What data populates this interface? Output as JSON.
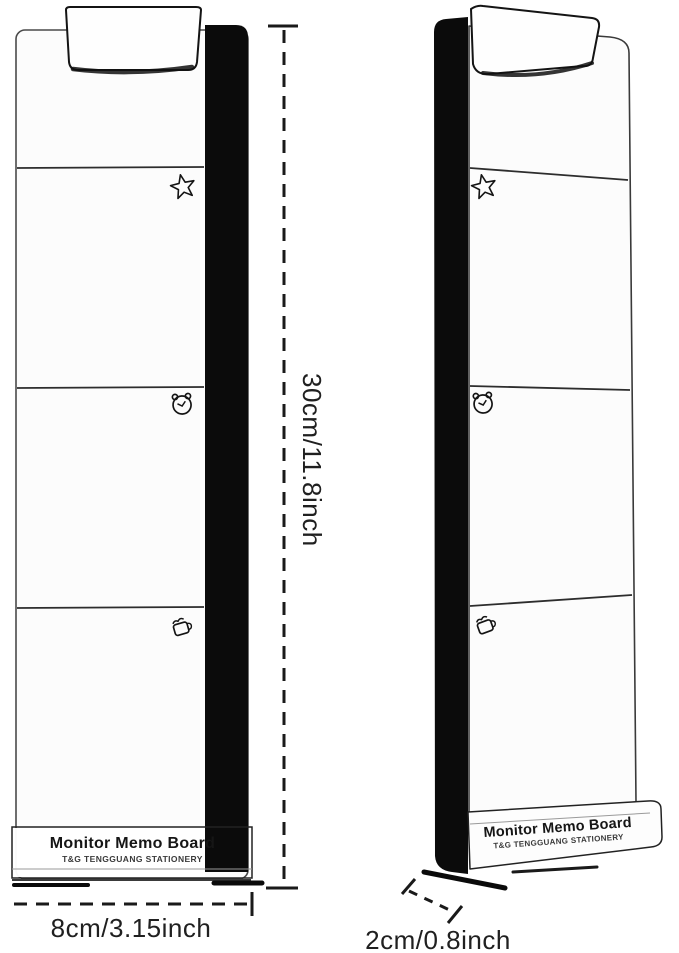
{
  "product": {
    "front_view": {
      "label_title": "Monitor Memo Board",
      "label_subtitle": "T&G TENGGUANG STATIONERY"
    },
    "side_view": {
      "label_title": "Monitor Memo Board",
      "label_subtitle": "T&G TENGGUANG STATIONERY"
    },
    "section_icons": [
      "star-icon",
      "alarm-clock-icon",
      "coffee-cup-icon"
    ]
  },
  "dimensions": {
    "height_label": "30cm/11.8inch",
    "width_label": "8cm/3.15inch",
    "depth_label": "2cm/0.8inch"
  },
  "colors": {
    "background": "#ffffff",
    "strip_black": "#0b0b0b",
    "outline": "#3a3a3a",
    "dimension_text": "#202020"
  }
}
